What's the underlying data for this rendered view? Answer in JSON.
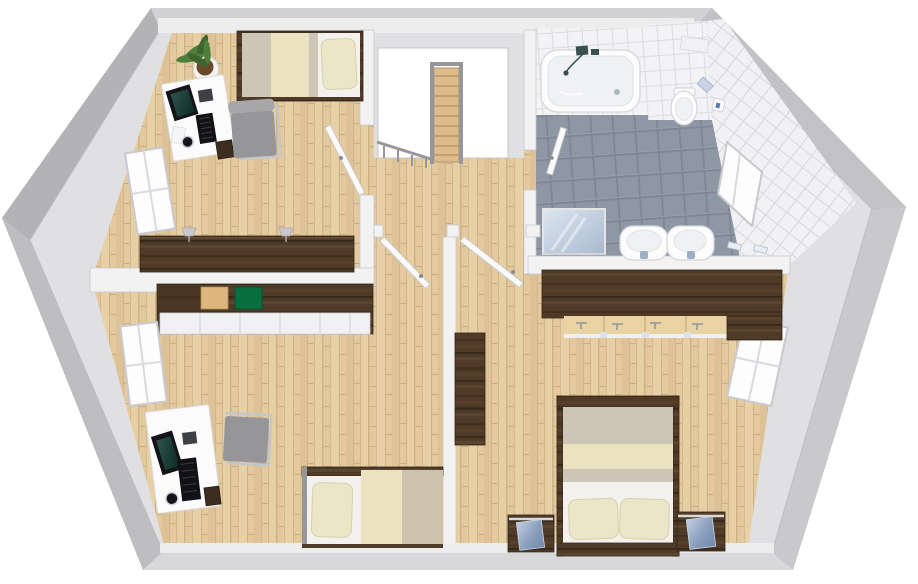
{
  "scene": {
    "title": "3D floor plan rendering — attic storey with two bedrooms, master bedroom, bathroom and stair landing",
    "view": "top-down isometric render",
    "background": "#ffffff"
  },
  "palette": {
    "roof_mid": "#c4c4c6",
    "roof_dark": "#b3b3b5",
    "roof_light": "#c9c9cb",
    "roof_bottom": "#d8d8da",
    "base_inner": "#e0e0e2",
    "wall_fill": "#f2f2f3",
    "wall_stroke": "#c9c9cc",
    "wood_floor": "#e3c99d",
    "gray_tile": "#8e97a4",
    "white_tile": "#f3f3f5",
    "dark_wood": "#4e3a27",
    "tan_box": "#dcb67c",
    "green_box": "#07703e",
    "duvet_gray": "#cdc5b6",
    "blanket_cream": "#ebe3bf",
    "pillow_cream": "#ece6c8",
    "sheet_white": "#f2f1ed",
    "chair_gray": "#95959a",
    "metal_gray": "#97979b",
    "porcelain": "#fcfcfd",
    "mirror_blue": "#a9b9cf",
    "glass_blue": "#8fa3c0",
    "flush_blue": "#c9d4e4",
    "plant_green": "#4e7d3c",
    "soil_brown": "#6a4a2a"
  },
  "rooms": [
    {
      "name": "bedroom-top-left",
      "floor": "wood",
      "objects": [
        "single-bed",
        "pillow",
        "blanket",
        "potted-plant",
        "desk",
        "monitor",
        "keyboard",
        "mouse-pad",
        "mug",
        "papers",
        "office-chair",
        "under-desk-container",
        "sideboard",
        "wall-lamp",
        "wall-lamp",
        "window",
        "door"
      ]
    },
    {
      "name": "hallway-landing",
      "floor": "wood",
      "objects": [
        "stairwell-opening",
        "staircase",
        "stair-railing",
        "landing-railing",
        "door-threshold",
        "door-threshold"
      ]
    },
    {
      "name": "bathroom",
      "floor": "gray-tile",
      "objects": [
        "bathtub",
        "bath-faucet",
        "hand-shower",
        "toilet",
        "flush-plate",
        "toilet-paper-holder",
        "washbasin",
        "washbasin",
        "basin-faucet",
        "mirror",
        "towel-holder",
        "towel-holder",
        "window",
        "door",
        "wall-shelf"
      ]
    },
    {
      "name": "bedroom-bottom-left",
      "floor": "wood",
      "objects": [
        "wardrobe",
        "storage-box-tan",
        "storage-box-green",
        "open-shelf-unit",
        "desk",
        "monitor",
        "keyboard",
        "mouse-pad",
        "mug",
        "office-chair",
        "under-desk-container",
        "single-bed",
        "pillow",
        "blanket",
        "window",
        "door"
      ]
    },
    {
      "name": "master-bedroom",
      "floor": "wood",
      "objects": [
        "double-bed",
        "pillow",
        "pillow",
        "headboard",
        "nightstand",
        "nightstand",
        "glass-front-box",
        "glass-front-box",
        "wardrobe-with-clothes-rail",
        "clothes-hangers",
        "dresser",
        "window",
        "door"
      ]
    }
  ]
}
